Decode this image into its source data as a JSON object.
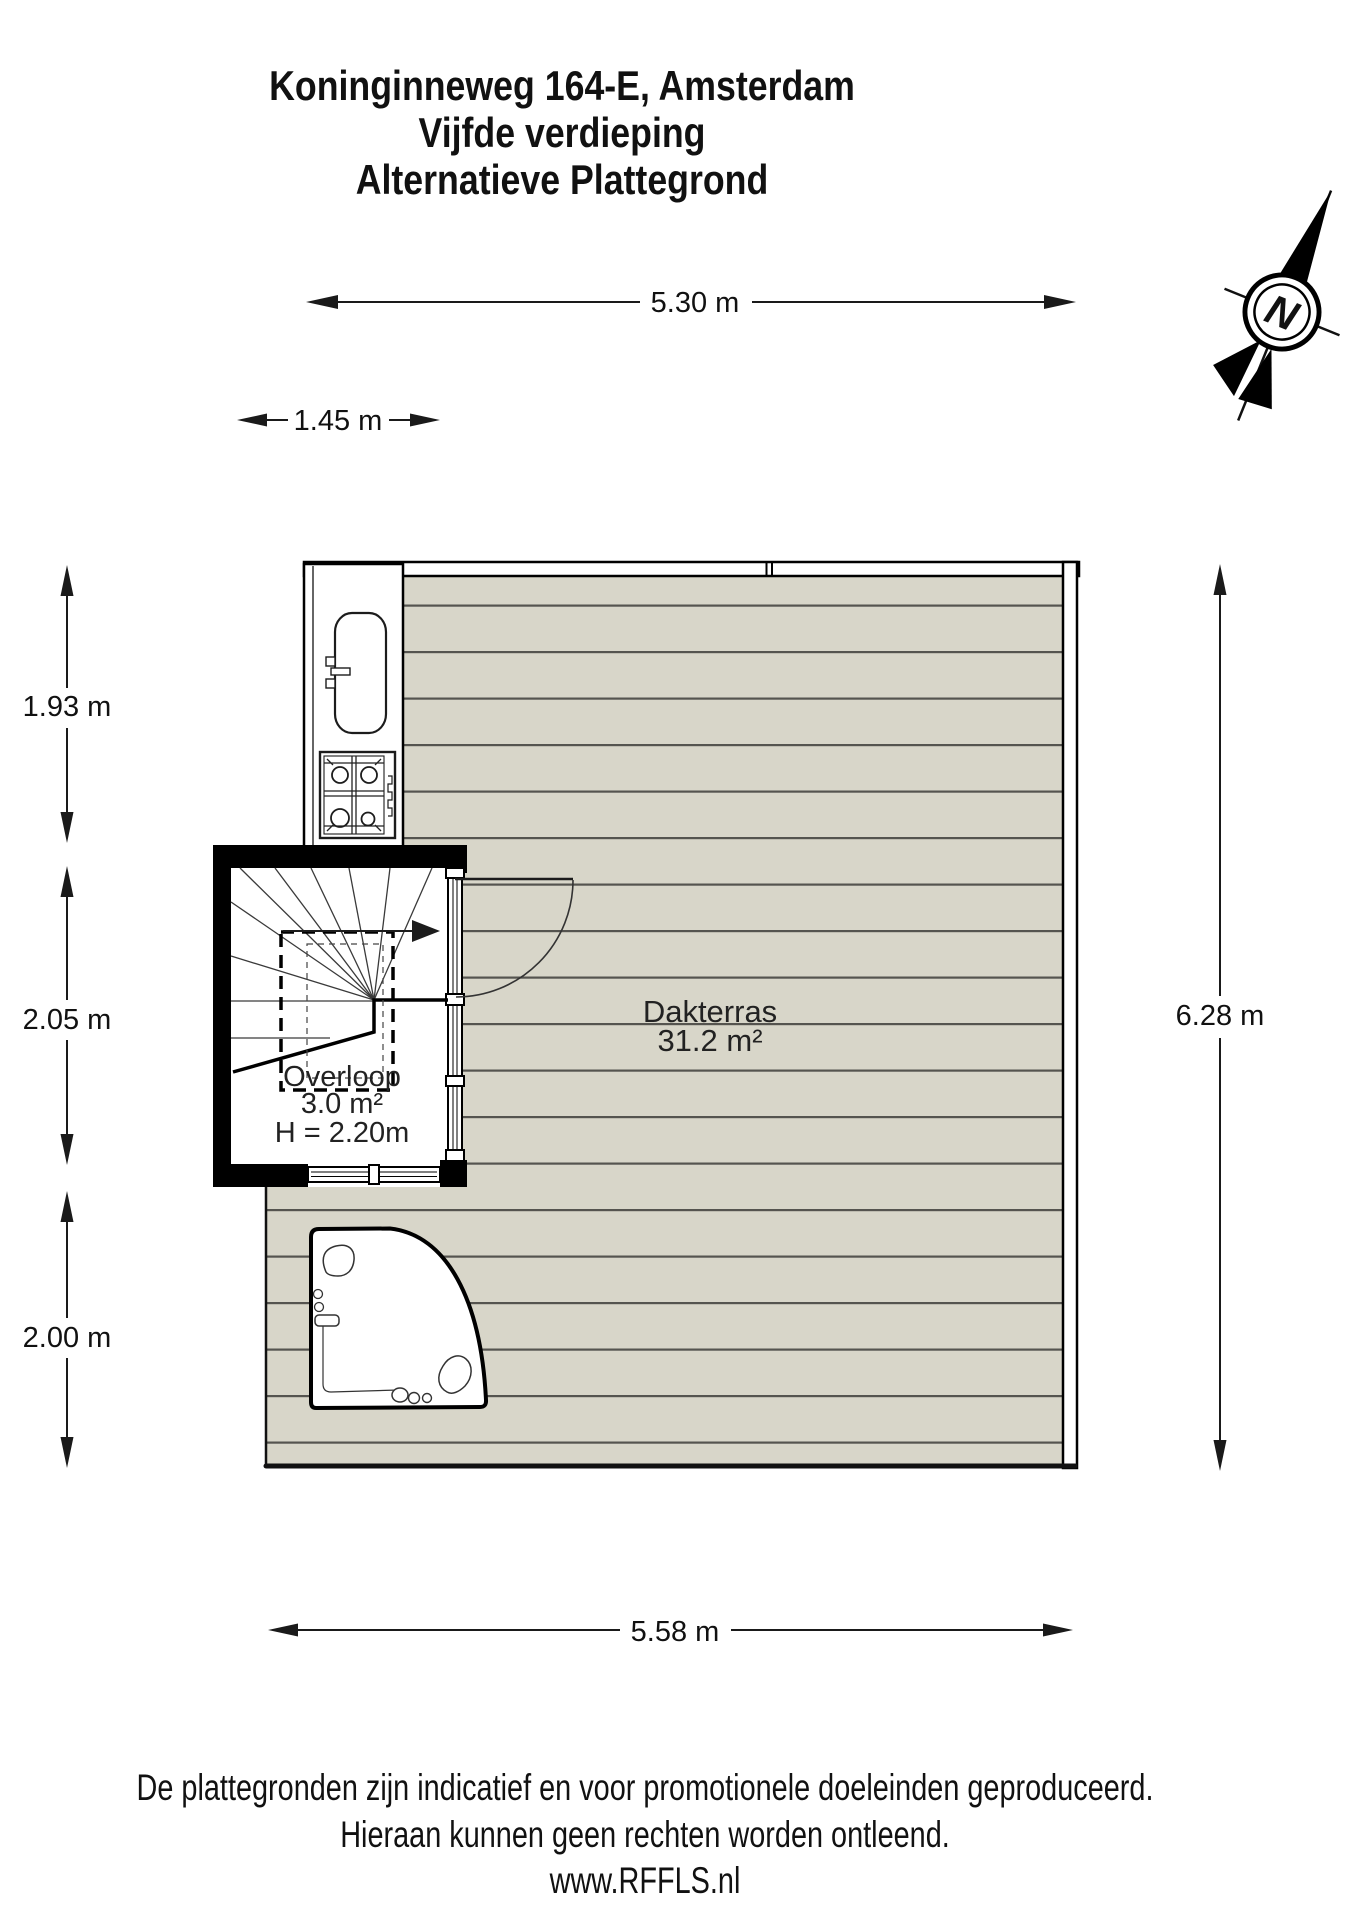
{
  "title": {
    "line1": "Koninginneweg 164-E, Amsterdam",
    "line2": "Vijfde verdieping",
    "line3": "Alternatieve Plattegrond"
  },
  "dimensions": {
    "top_width": "5.30 m",
    "stairwell_width": "1.45 m",
    "left_top": "1.93 m",
    "left_middle": "2.05 m",
    "left_bottom": "2.00 m",
    "right_height": "6.28 m",
    "bottom_width": "5.58 m"
  },
  "rooms": {
    "dakterras": {
      "name": "Dakterras",
      "area": "31.2 m²"
    },
    "overloop": {
      "name": "Overloop",
      "area": "3.0 m²",
      "ceiling_height": "H = 2.20m"
    }
  },
  "compass": {
    "north_label": "N"
  },
  "footer": {
    "line1": "De plattegronden zijn indicatief en voor promotionele doeleinden geproduceerd.",
    "line2": "Hieraan kunnen geen rechten worden ontleend.",
    "line3": "www.RFFLS.nl"
  },
  "colors": {
    "deck_fill": "#d8d6c9",
    "deck_line": "#55544f",
    "wall": "#000000",
    "text": "#111111"
  }
}
